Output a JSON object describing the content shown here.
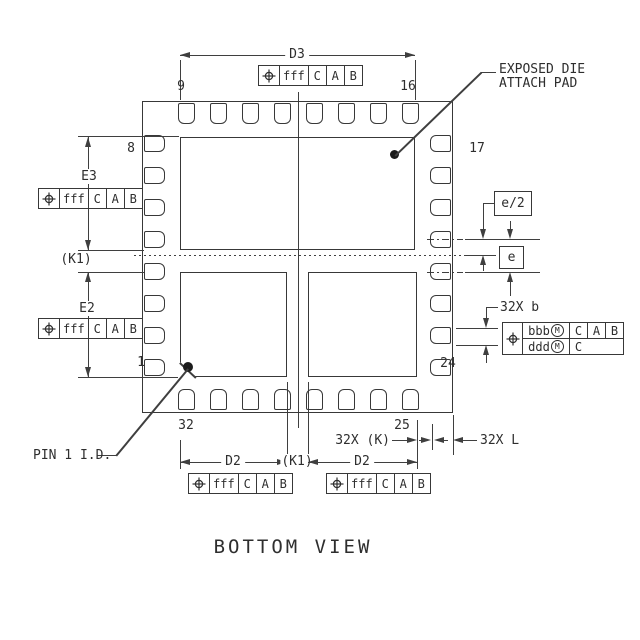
{
  "view_title": "BOTTOM VIEW",
  "callouts": {
    "exposed_die_line1": "EXPOSED DIE",
    "exposed_die_line2": "ATTACH PAD",
    "pin1_id": "PIN 1 I.D."
  },
  "dimensions": {
    "d3": "D3",
    "e3": "E3",
    "e2": "E2",
    "d2_left": "D2",
    "d2_right": "D2",
    "k1_left": "(K1)",
    "k1_bottom": "(K1)",
    "e_half": "e/2",
    "pitch_e": "e",
    "terminal_width": "32X b",
    "terminal_gap": "32X (K)",
    "terminal_length": "32X L"
  },
  "pin_labels": {
    "pin1": "1",
    "pin8": "8",
    "pin9": "9",
    "pin16": "16",
    "pin17": "17",
    "pin24": "24",
    "pin25": "25",
    "pin32": "32"
  },
  "fcf_fff": {
    "tolerance": "fff",
    "datum1": "C",
    "datum2": "A",
    "datum3": "B"
  },
  "fcf_terminal": {
    "row1_tolerance": "bbb",
    "row1_modifier": "M",
    "row1_datum1": "C",
    "row1_datum2": "A",
    "row1_datum3": "B",
    "row2_tolerance": "ddd",
    "row2_modifier": "M",
    "row2_datum1": "C"
  },
  "colors": {
    "line": "#3f3f3f",
    "text": "#2e2e2e",
    "background": "#ffffff"
  }
}
